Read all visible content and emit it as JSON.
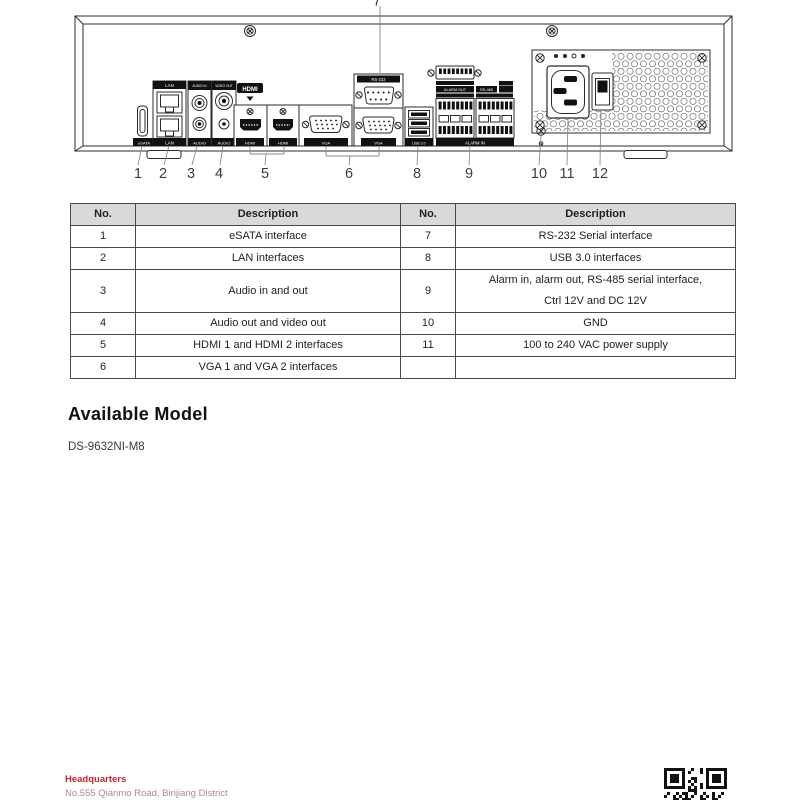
{
  "diagram": {
    "callout_top_number": "7",
    "numbers": [
      "1",
      "2",
      "3",
      "4",
      "5",
      "6",
      "8",
      "9",
      "10",
      "11",
      "12"
    ],
    "port_labels": {
      "esata": "eSATA",
      "lan_top": "LAN",
      "lan_bottom": "LAN",
      "audio_in": "AUDIO IN",
      "audio_out_3": "AUDIO",
      "video_out": "VIDEO OUT",
      "audio_out_4": "AUDIO",
      "hdmi_logo": "HDMI",
      "hdmi_1": "HDMI",
      "hdmi_2": "HDMI",
      "vga_1": "VGA",
      "vga_2": "VGA",
      "rs232": "RS-232",
      "usb": "USB 3.0",
      "alarm_out": "ALARM OUT",
      "rs485": "RS-485",
      "alarm_in": "ALARM IN"
    }
  },
  "table": {
    "headers": [
      "No.",
      "Description",
      "No.",
      "Description"
    ],
    "rows": [
      {
        "no1": "1",
        "desc1": "eSATA interface",
        "no2": "7",
        "desc2": "RS-232 Serial interface"
      },
      {
        "no1": "2",
        "desc1": "LAN interfaces",
        "no2": "8",
        "desc2": "USB 3.0 interfaces"
      },
      {
        "no1": "3",
        "desc1": "Audio in and out",
        "no2": "9",
        "desc2": "Alarm in, alarm out, RS-485 serial interface, Ctrl 12V and DC 12V",
        "desc2_lines": [
          "Alarm in, alarm out, RS-485 serial interface,",
          "Ctrl 12V and DC 12V"
        ]
      },
      {
        "no1": "4",
        "desc1": "Audio out and video out",
        "no2": "10",
        "desc2": "GND"
      },
      {
        "no1": "5",
        "desc1": "HDMI 1 and HDMI 2 interfaces",
        "no2": "11",
        "desc2": "100 to 240 VAC power supply"
      },
      {
        "no1": "6",
        "desc1": "VGA 1 and VGA 2 interfaces",
        "no2": "",
        "desc2": ""
      }
    ]
  },
  "model_section": {
    "heading": "Available Model",
    "model": "DS-9632NI-M8"
  },
  "footer": {
    "headquarters_label": "Headquarters",
    "address": "No.555 Qianmo Road, Binjiang District"
  },
  "colors": {
    "accent_red": "#c1272d",
    "address_red": "#b28989",
    "table_header_bg": "#d9d9d9",
    "line_color": "#2b2b2b"
  }
}
